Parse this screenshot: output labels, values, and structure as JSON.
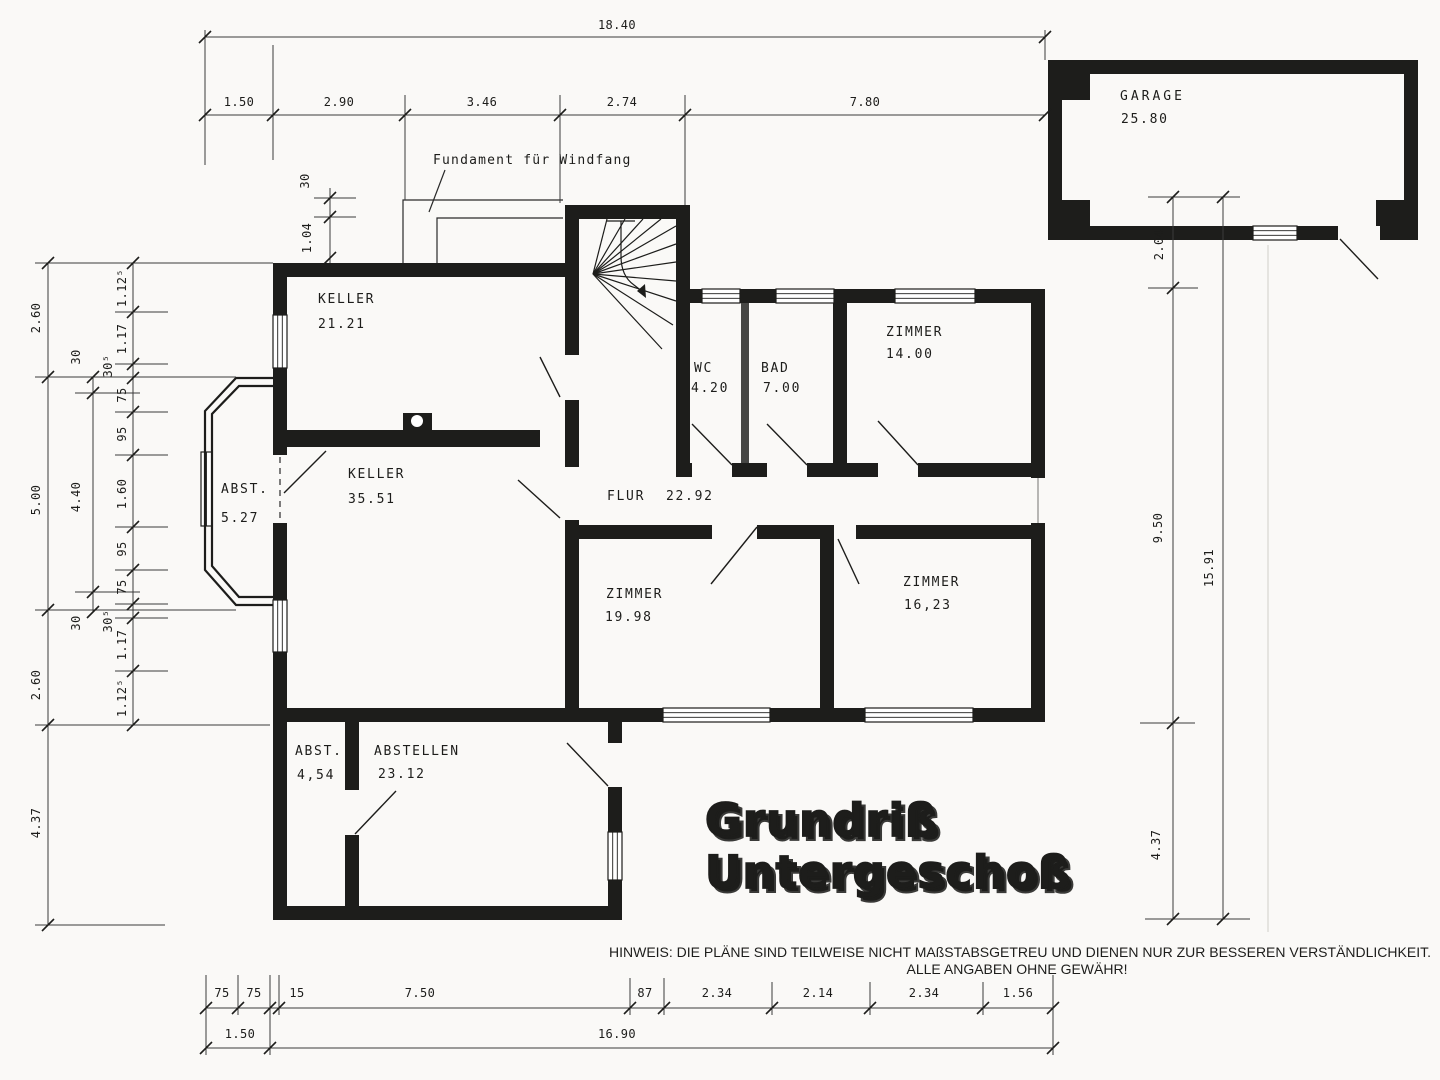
{
  "title": {
    "line1": "Grundriß",
    "line2": "Untergeschoß"
  },
  "note": {
    "line1": "HINWEIS: DIE PLÄNE SIND TEILWEISE NICHT MAßSTABSGETREU UND DIENEN NUR ZUR BESSEREN VERSTÄNDLICHKEIT.",
    "line2": "ALLE ANGABEN OHNE GEWÄHR!"
  },
  "annotations": {
    "windfang": "Fundament für Windfang"
  },
  "rooms": {
    "keller1": {
      "name": "KELLER",
      "area": "21.21"
    },
    "keller2": {
      "name": "KELLER",
      "area": "35.51"
    },
    "abst1": {
      "name": "ABST.",
      "area": "5.27"
    },
    "wc": {
      "name": "WC",
      "area": "4.20"
    },
    "bad": {
      "name": "BAD",
      "area": "7.00"
    },
    "zimmer1": {
      "name": "ZIMMER",
      "area": "14.00"
    },
    "flur": {
      "name": "FLUR",
      "area": "22.92"
    },
    "zimmer2": {
      "name": "ZIMMER",
      "area": "19.98"
    },
    "zimmer3": {
      "name": "ZIMMER",
      "area": "16,23"
    },
    "abst2": {
      "name": "ABST.",
      "area": "4,54"
    },
    "abstellen": {
      "name": "ABSTELLEN",
      "area": "23.12"
    },
    "garage": {
      "name": "GARAGE",
      "area": "25.80"
    }
  },
  "dims": {
    "top_total": "18.40",
    "top": [
      "1.50",
      "2.90",
      "3.46",
      "2.74",
      "7.80"
    ],
    "left_outer": [
      "2.60",
      "5.00",
      "2.60",
      "4.37"
    ],
    "left_mid": [
      "30",
      "4.40",
      "30"
    ],
    "left_inner": [
      "1.12⁵",
      "1.17",
      "30⁵",
      "75",
      "95",
      "1.60",
      "95",
      "75",
      "30⁵",
      "1.17",
      "1.12⁵"
    ],
    "windfang": [
      "30",
      "1.04"
    ],
    "right": [
      "2.04",
      "9.50",
      "4.37",
      "15.91"
    ],
    "bottom_row1": [
      "75",
      "75",
      "15",
      "7.50",
      "87",
      "2.34",
      "2.14",
      "2.34",
      "1.56"
    ],
    "bottom_row2": [
      "1.50",
      "16.90"
    ]
  },
  "colors": {
    "wall": "#1d1d1b",
    "note_blue": "#2e3a9c",
    "paper": "#faf9f7"
  }
}
